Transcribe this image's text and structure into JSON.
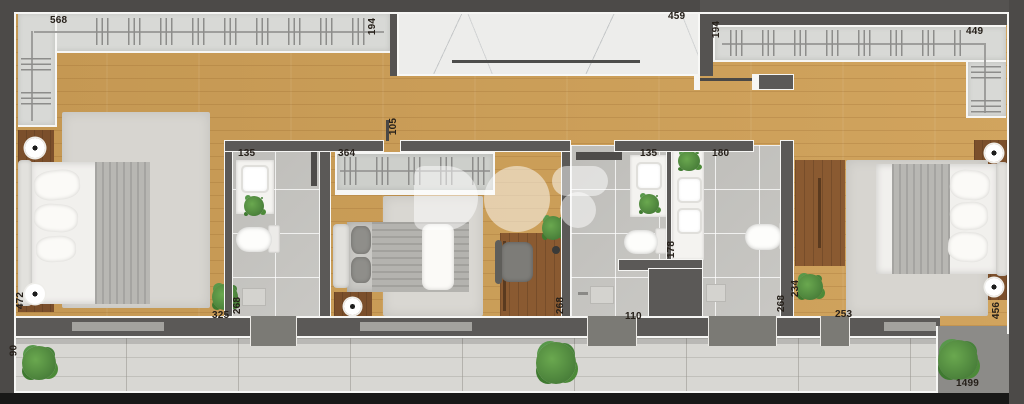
{
  "plan": {
    "type": "apartment-floor-plan-render",
    "watermark_logo": "DO:S",
    "colors": {
      "outer_wall": "#4c4a48",
      "inner_wall": "#5b5957",
      "wall_outline": "#f6f6f4",
      "wood_floor": "#cfa057",
      "dark_wood_furniture": "#8a5a31",
      "bathroom_tile": "#c6c5c1",
      "balcony_tile": "#d8d7d3",
      "marble_floor": "#ededeb",
      "rug": "#d7d5d0",
      "plant_green": "#4c8a38",
      "label_text": "#26201a",
      "facade_shadow": "#181817"
    }
  },
  "labels": [
    {
      "text": "568",
      "orientation": "horizontal"
    },
    {
      "text": "194",
      "orientation": "vertical"
    },
    {
      "text": "459",
      "orientation": "horizontal"
    },
    {
      "text": "194",
      "orientation": "vertical"
    },
    {
      "text": "449",
      "orientation": "horizontal"
    },
    {
      "text": "105",
      "orientation": "vertical"
    },
    {
      "text": "135",
      "orientation": "horizontal"
    },
    {
      "text": "364",
      "orientation": "horizontal"
    },
    {
      "text": "135",
      "orientation": "horizontal"
    },
    {
      "text": "180",
      "orientation": "horizontal"
    },
    {
      "text": "178",
      "orientation": "vertical"
    },
    {
      "text": "472",
      "orientation": "vertical"
    },
    {
      "text": "90",
      "orientation": "vertical"
    },
    {
      "text": "325",
      "orientation": "horizontal"
    },
    {
      "text": "268",
      "orientation": "vertical"
    },
    {
      "text": "268",
      "orientation": "vertical"
    },
    {
      "text": "110",
      "orientation": "horizontal"
    },
    {
      "text": "268",
      "orientation": "vertical"
    },
    {
      "text": "234",
      "orientation": "vertical"
    },
    {
      "text": "253",
      "orientation": "horizontal"
    },
    {
      "text": "456",
      "orientation": "vertical"
    },
    {
      "text": "1499",
      "orientation": "horizontal"
    }
  ]
}
